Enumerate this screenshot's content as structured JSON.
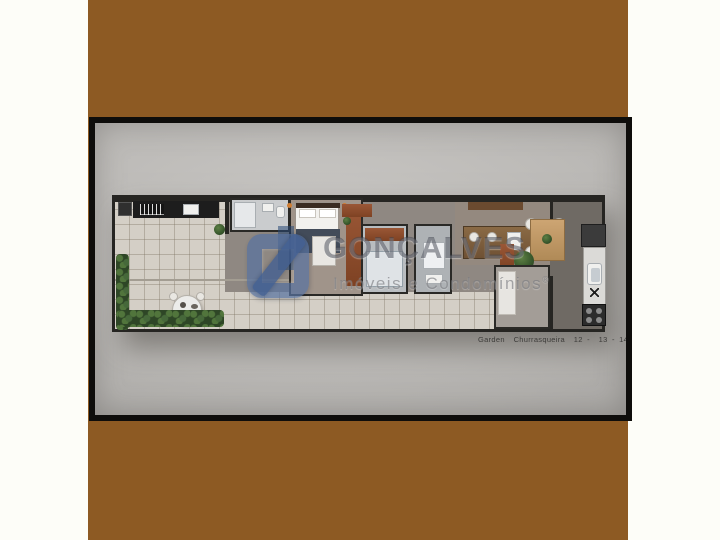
{
  "photo": {
    "caption": "Garden  Churrasqueira  12 -  13 - 14"
  },
  "watermark": {
    "brand": "GONÇALVES",
    "tagline": "Imóveis e Condomínios",
    "registered_mark": "®",
    "logo_icon": "blue-rounded-square-mark"
  },
  "colors": {
    "backdrop_brown": "#8d5a23",
    "page_white": "#fdfdf8",
    "frame_black": "#0e0d0b",
    "photo_gray": "#b7b5b2",
    "wall_dark": "#262522",
    "tile_floor": "#d4cfc6",
    "furniture_rust": "#8a4a2c",
    "hedge_green": "#2e4626",
    "logo_blue": "#5872a0",
    "logo_navy": "#2c4876"
  }
}
